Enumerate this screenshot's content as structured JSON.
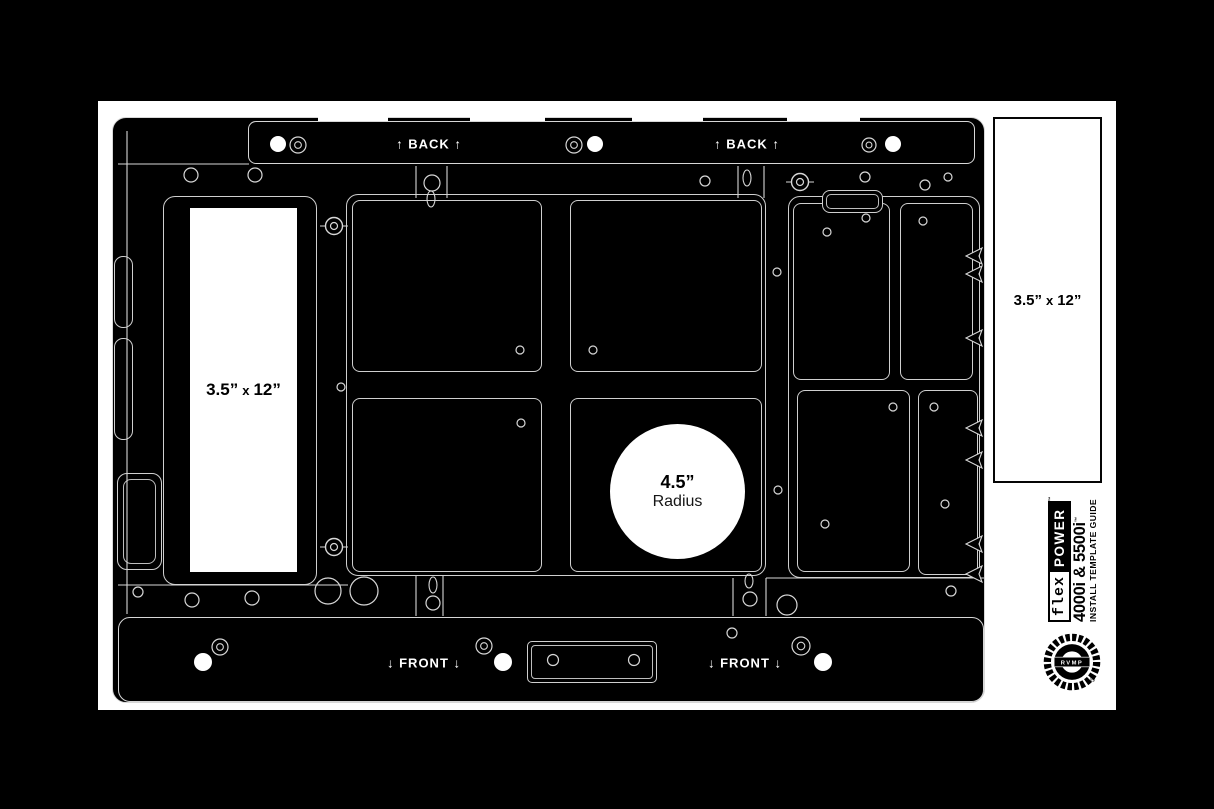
{
  "canvas": {
    "width": 1214,
    "height": 809,
    "background": "#000000"
  },
  "colors": {
    "line": "#d7d7d7",
    "paper": "#ffffff",
    "ink": "#000000"
  },
  "labels": {
    "back_left": "↑ BACK ↑",
    "back_right": "↑ BACK ↑",
    "front_left": "↓ FRONT ↓",
    "front_right": "↓ FRONT ↓",
    "left_slot": {
      "size_a": "3.5”",
      "times": "x",
      "size_b": "12”"
    },
    "right_panel": {
      "size_a": "3.5”",
      "times": "x",
      "size_b": "12”"
    },
    "radius_value": "4.5”",
    "radius_word": "Radius"
  },
  "branding": {
    "rvmp_small": "RVMP",
    "flex": "flex",
    "power": "POWER",
    "trademark": "™",
    "model": "4000i & 5500i",
    "model_tm": "™",
    "subtitle": "INSTALL TEMPLATE GUIDE",
    "logo_text": "RVMP",
    "registered": "®"
  },
  "drawing": {
    "holes": [
      [
        278,
        144,
        8
      ],
      [
        595,
        144,
        8
      ],
      [
        893,
        144,
        8
      ],
      [
        203,
        662,
        9
      ],
      [
        503,
        662,
        9
      ],
      [
        823,
        662,
        9
      ]
    ],
    "rings": [
      [
        298,
        145,
        8
      ],
      [
        574,
        145,
        8
      ],
      [
        869,
        145,
        7
      ],
      [
        220,
        647,
        8
      ],
      [
        484,
        646,
        8
      ],
      [
        801,
        646,
        9
      ]
    ],
    "bolts": [
      [
        334,
        226
      ],
      [
        334,
        547
      ],
      [
        800,
        182
      ]
    ],
    "circles": [
      [
        191,
        175,
        7
      ],
      [
        255,
        175,
        7
      ],
      [
        432,
        183,
        8
      ],
      [
        705,
        181,
        5
      ],
      [
        865,
        177,
        5
      ],
      [
        925,
        185,
        5
      ],
      [
        948,
        177,
        4
      ],
      [
        866,
        218,
        4
      ],
      [
        923,
        221,
        4
      ],
      [
        827,
        232,
        4
      ],
      [
        520,
        350,
        4
      ],
      [
        593,
        350,
        4
      ],
      [
        521,
        423,
        4
      ],
      [
        341,
        387,
        4
      ],
      [
        777,
        272,
        4
      ],
      [
        778,
        490,
        4
      ],
      [
        893,
        407,
        4
      ],
      [
        934,
        407,
        4
      ],
      [
        825,
        524,
        4
      ],
      [
        945,
        504,
        4
      ],
      [
        138,
        592,
        5
      ],
      [
        192,
        600,
        7
      ],
      [
        252,
        598,
        7
      ],
      [
        328,
        591,
        13
      ],
      [
        364,
        591,
        14
      ],
      [
        433,
        603,
        7
      ],
      [
        750,
        599,
        7
      ],
      [
        787,
        605,
        10
      ],
      [
        951,
        591,
        5
      ],
      [
        732,
        633,
        5
      ],
      [
        553,
        660,
        5.5
      ],
      [
        634,
        660,
        5.5
      ]
    ],
    "ovals": [
      [
        431,
        199,
        4,
        8
      ],
      [
        747,
        178,
        4,
        8
      ],
      [
        433,
        585,
        4,
        8
      ],
      [
        749,
        581,
        4,
        7
      ]
    ],
    "vlines": [
      [
        416,
        166,
        198
      ],
      [
        447,
        166,
        198
      ],
      [
        738,
        166,
        198
      ],
      [
        764,
        166,
        198
      ],
      [
        416,
        576,
        616
      ],
      [
        443,
        576,
        616
      ],
      [
        733,
        578,
        616
      ],
      [
        766,
        578,
        616
      ],
      [
        127,
        131,
        614
      ]
    ],
    "hlines": [
      [
        118,
        249,
        164
      ],
      [
        118,
        348,
        585
      ],
      [
        766,
        984,
        578
      ]
    ],
    "arrows": [
      [
        966,
        256
      ],
      [
        966,
        274
      ],
      [
        966,
        338
      ],
      [
        966,
        428
      ],
      [
        966,
        460
      ],
      [
        966,
        544
      ],
      [
        966,
        574
      ]
    ]
  }
}
